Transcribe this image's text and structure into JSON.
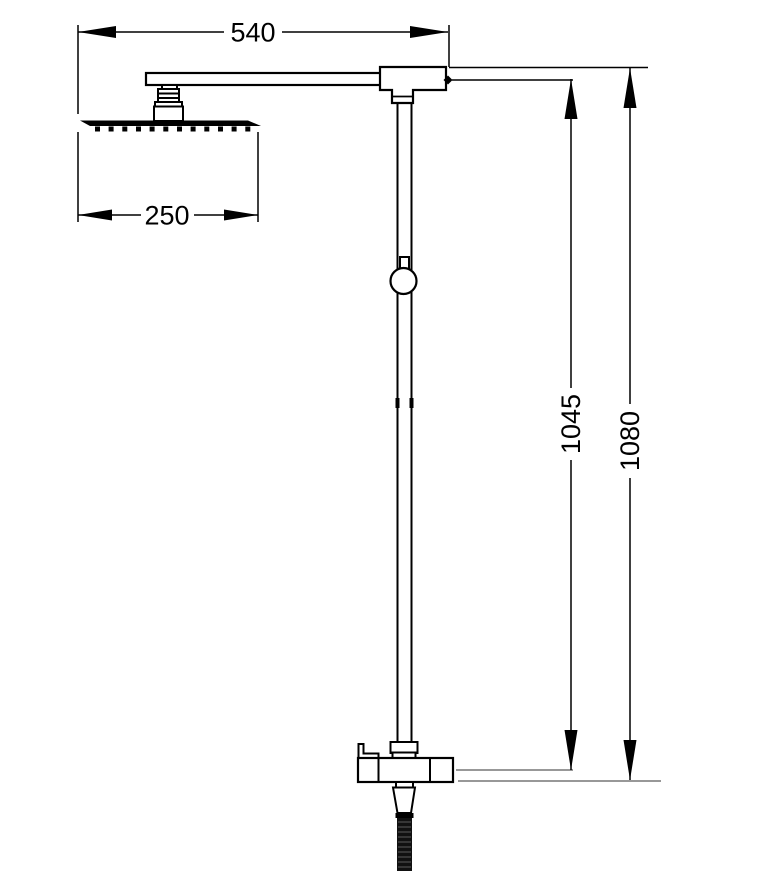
{
  "drawing": {
    "kind": "technical-dimension-drawing",
    "subject": "shower column with overhead rain head and hand shower",
    "background_color": "#ffffff",
    "line_color": "#000000",
    "ref_line_color": "#777777"
  },
  "dimensions": {
    "arm_span": "540",
    "head_width": "250",
    "riser_height": "1045",
    "overall_height": "1080"
  }
}
